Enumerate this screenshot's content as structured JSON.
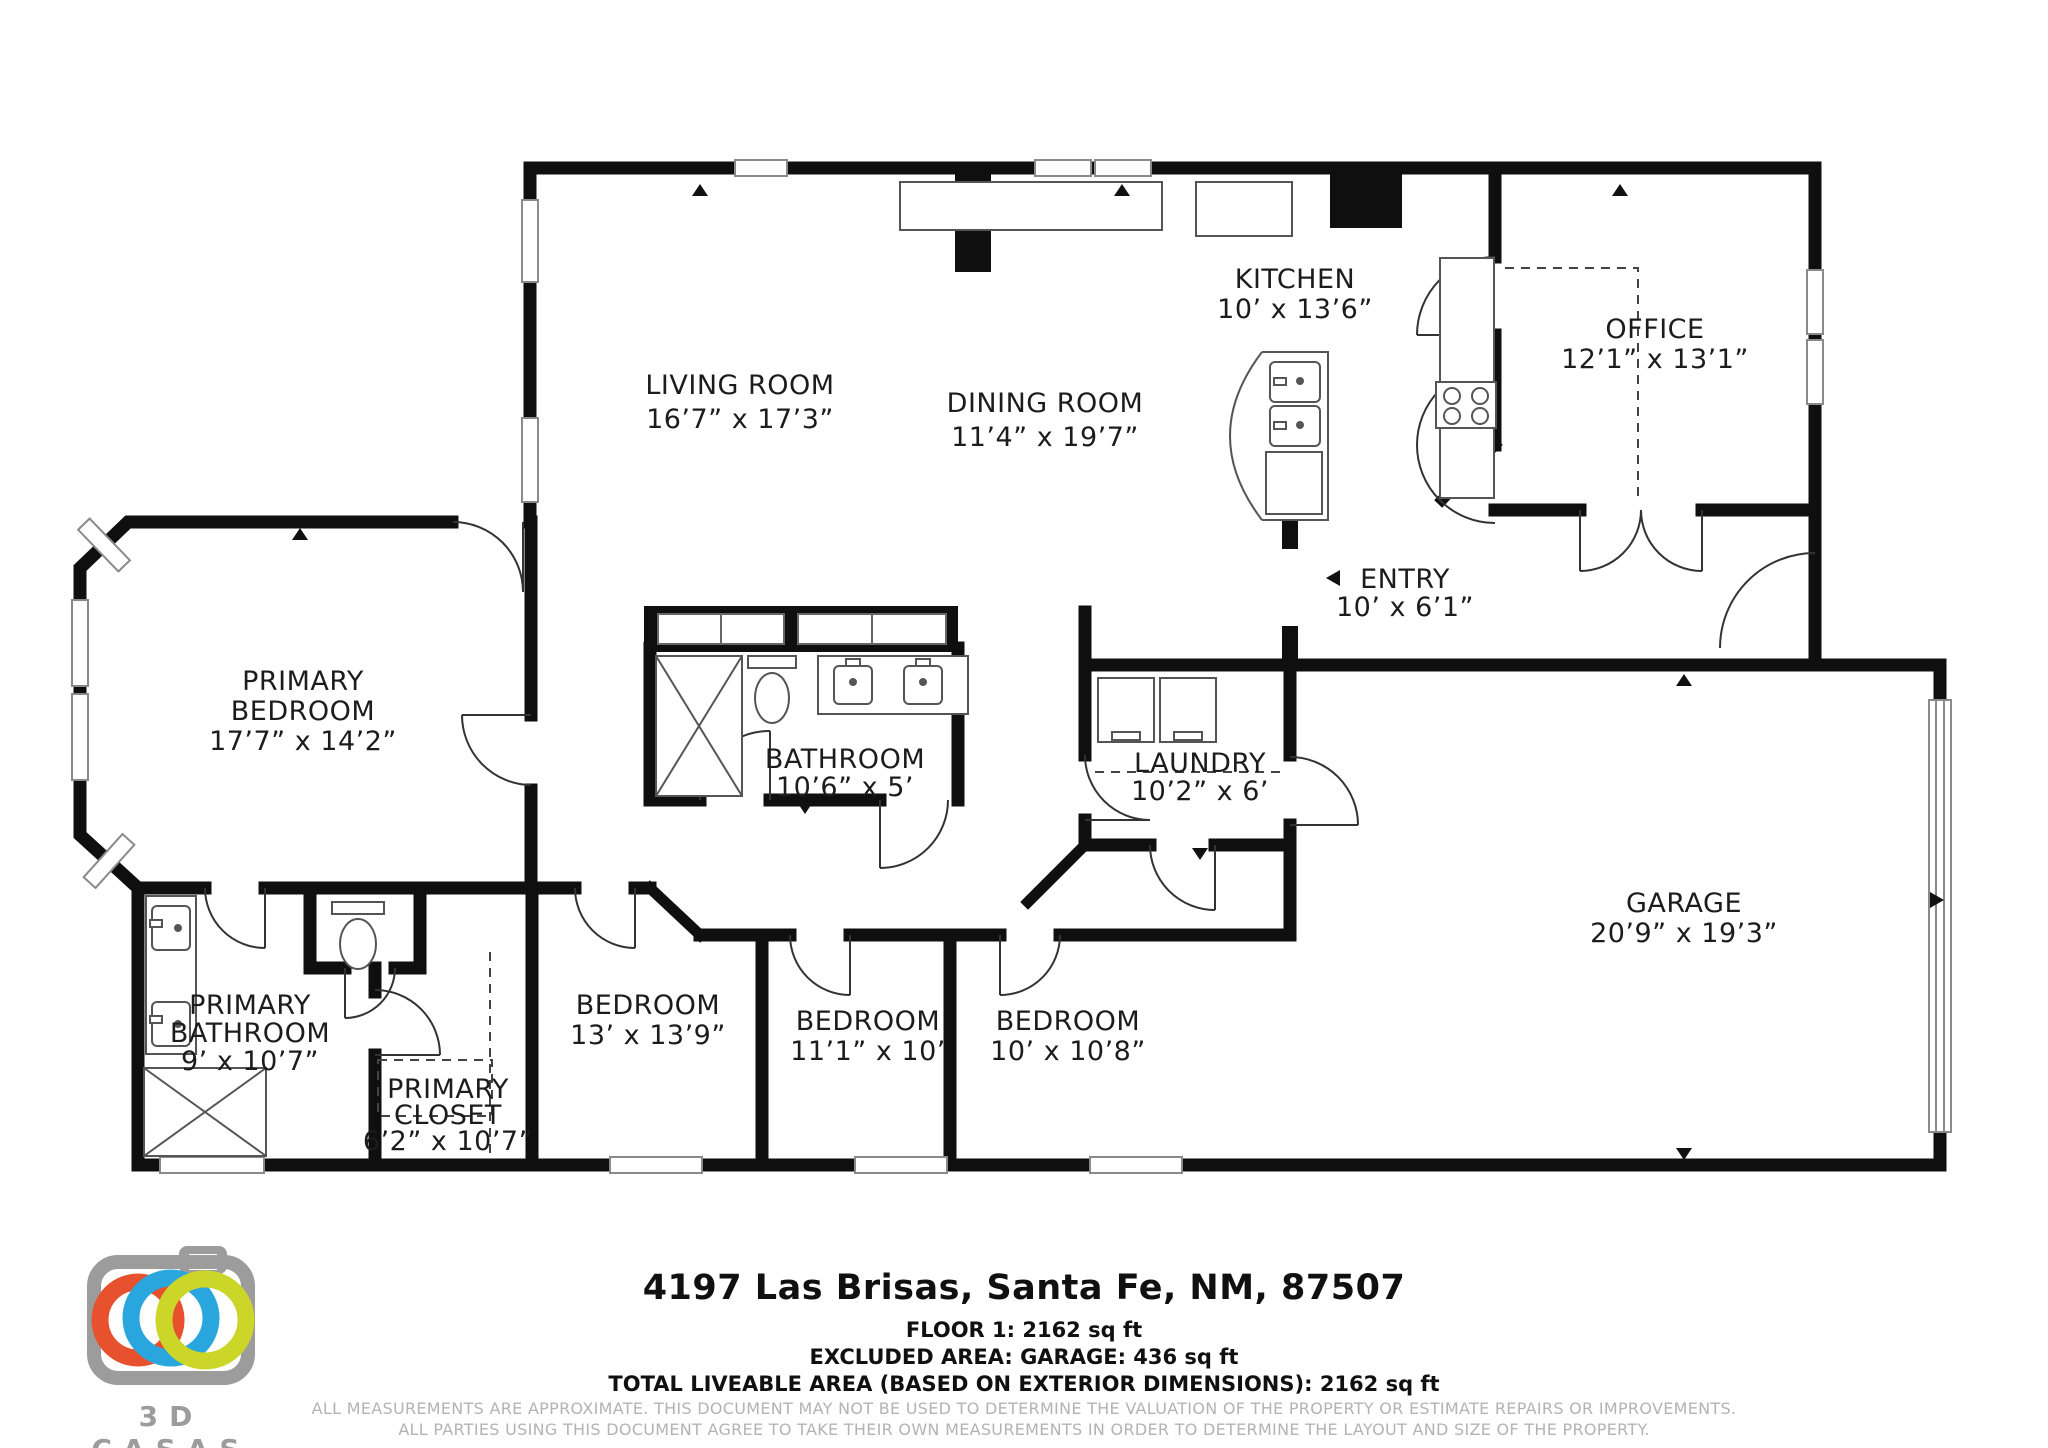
{
  "rooms": [
    {
      "id": "living-room",
      "lines": [
        "LIVING ROOM",
        "16’7” x 17’3”"
      ]
    },
    {
      "id": "dining-room",
      "lines": [
        "DINING ROOM",
        "11’4” x 19’7”"
      ]
    },
    {
      "id": "kitchen",
      "lines": [
        "KITCHEN",
        "10’ x 13’6”"
      ]
    },
    {
      "id": "office",
      "lines": [
        "OFFICE",
        "12’1” x 13’1”"
      ]
    },
    {
      "id": "entry",
      "lines": [
        "ENTRY",
        "10’ x 6’1”"
      ]
    },
    {
      "id": "primary-bedroom",
      "lines": [
        "PRIMARY",
        "BEDROOM",
        "17’7” x 14’2”"
      ]
    },
    {
      "id": "bathroom",
      "lines": [
        "BATHROOM",
        "10’6” x 5’"
      ]
    },
    {
      "id": "laundry",
      "lines": [
        "LAUNDRY",
        "10’2” x 6’"
      ]
    },
    {
      "id": "garage",
      "lines": [
        "GARAGE",
        "20’9” x 19’3”"
      ]
    },
    {
      "id": "bedroom-1",
      "lines": [
        "BEDROOM",
        "13’ x 13’9”"
      ]
    },
    {
      "id": "bedroom-2",
      "lines": [
        "BEDROOM",
        "11’1” x 10’"
      ]
    },
    {
      "id": "bedroom-3",
      "lines": [
        "BEDROOM",
        "10’ x 10’8”"
      ]
    },
    {
      "id": "primary-bathroom",
      "lines": [
        "PRIMARY",
        "BATHROOM",
        "9’ x 10’7”"
      ]
    },
    {
      "id": "primary-closet",
      "lines": [
        "PRIMARY",
        "CLOSET",
        "6’2” x 10’7”"
      ]
    }
  ],
  "footer": {
    "address": "4197 Las Brisas, Santa Fe, NM, 87507",
    "floor": "FLOOR 1: 2162 sq ft",
    "excluded": "EXCLUDED AREA: GARAGE: 436 sq ft",
    "total": "TOTAL LIVEABLE AREA (BASED ON EXTERIOR DIMENSIONS): 2162 sq ft",
    "disclaimer1": "ALL MEASUREMENTS ARE APPROXIMATE. THIS DOCUMENT MAY NOT BE USED TO DETERMINE THE VALUATION OF THE PROPERTY OR ESTIMATE REPAIRS OR IMPROVEMENTS.",
    "disclaimer2": "ALL PARTIES USING THIS DOCUMENT AGREE TO TAKE THEIR OWN MEASUREMENTS IN ORDER TO DETERMINE THE LAYOUT AND SIZE OF THE PROPERTY."
  },
  "logo": {
    "text": "3D CASAS",
    "camera_gray": "#9c9c9c",
    "ring_orange": "#e8512e",
    "ring_blue": "#2aa6de",
    "ring_green": "#ccd629"
  },
  "colors": {
    "walls": "#0f0f0f",
    "labels": "#1c1c1c",
    "fixtures": "#555555",
    "disclaimer_gray": "#b3b3b3"
  }
}
